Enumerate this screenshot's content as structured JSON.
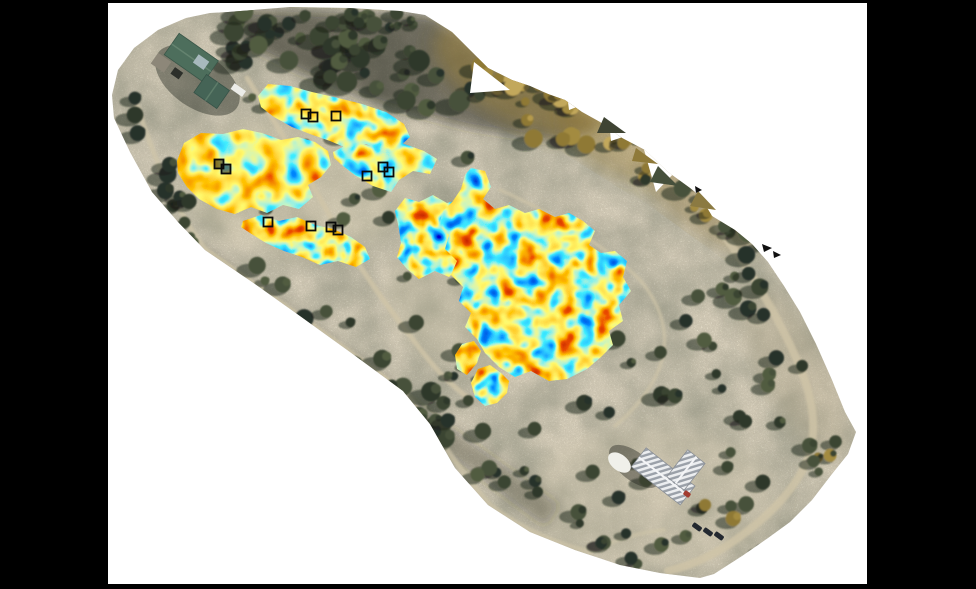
{
  "meta": {
    "description": "Aerial drone orthomosaic of a wooded survey site shown on a white figure canvas over a black background. Irregular geophysical (GPR) heatmap patches in a jet colormap are overlaid on mowed survey lanes; small black open squares mark excavation/test units. A green-roofed building complex sits at the upper left and a white metal-roofed building at the lower right, with dirt paths and scattered trees throughout.",
    "visible_text": []
  },
  "frame": {
    "background": "#000000",
    "canvas": {
      "fill": "#ffffff",
      "x": 108,
      "y": 3,
      "width": 759,
      "height": 581
    }
  },
  "palette": {
    "jet_stops": [
      "#000099",
      "#0033ff",
      "#00ccff",
      "#ffee33",
      "#ff9900",
      "#d91800",
      "#800000"
    ],
    "terrain_tan": "#a89a82",
    "road_tan": "#cfc4a8",
    "tree_dark": "#3a4431",
    "tree_gold": "#a8903f",
    "marker_black": "#0a0a0a",
    "roof_green": "#4d6e5c",
    "roof_white": "#eceef0"
  },
  "ortho": {
    "outline": "228,12 290,7 350,8 400,11 425,15 452,32 470,50 488,68 512,80 530,86 548,94 565,100 582,112 600,122 622,138 645,150 668,172 690,188 700,196 712,216 735,230 752,244 768,262 784,286 800,312 816,344 832,380 845,412 856,432 848,454 832,474 812,500 790,522 768,538 742,556 714,574 700,578 660,573 620,565 575,550 530,532 488,505 455,468 430,424 403,391 350,352 300,316 255,284 205,250 178,222 152,192 130,152 114,118 112,95 118,70 134,48 158,30 186,18 210,13",
    "terrain_noise": {
      "freq": 0.7,
      "octaves": 3,
      "seed": 9,
      "r_table": "0.50 0.72 0.58 0.80 0.64",
      "g_table": "0.46 0.66 0.53 0.74 0.59",
      "b_table": "0.36 0.52 0.42 0.60 0.47"
    }
  },
  "notches": [
    {
      "points": "474,62 510,90 470,93"
    },
    {
      "points": "643,146 696,150 656,192"
    },
    {
      "points": "566,86 592,101 569,110"
    },
    {
      "points": "609,121 629,135 611,141"
    }
  ],
  "teeth": [
    {
      "points": "604,117 626,133 597,133",
      "fill": "#3f4433"
    },
    {
      "points": "658,166 678,186 650,182",
      "fill": "#46503c"
    },
    {
      "points": "698,191 716,210 690,206",
      "fill": "#8b7a42"
    },
    {
      "points": "636,148 658,164 632,161",
      "fill": "#8f7a3a"
    }
  ],
  "tints": [
    {
      "shape": "polygon",
      "points": "232,10 430,16 600,124 560,142 470,128 380,104 300,72 240,42",
      "fill": "rgba(36,40,28,0.55)",
      "blur": "soft6"
    },
    {
      "shape": "ellipse",
      "cx": 520,
      "cy": 78,
      "rx": 95,
      "ry": 45,
      "rot": 28,
      "fill": "rgba(168,138,58,0.45)",
      "blur": "soft8"
    },
    {
      "shape": "ellipse",
      "cx": 615,
      "cy": 140,
      "rx": 62,
      "ry": 32,
      "rot": 32,
      "fill": "rgba(150,122,52,0.38)",
      "blur": "soft8"
    },
    {
      "shape": "ellipse",
      "cx": 698,
      "cy": 205,
      "rx": 70,
      "ry": 24,
      "rot": 36,
      "fill": "rgba(158,128,58,0.33)",
      "blur": "soft8"
    },
    {
      "shape": "ellipse",
      "cx": 300,
      "cy": 185,
      "rx": 115,
      "ry": 72,
      "rot": 0,
      "fill": "rgba(208,198,170,0.34)",
      "blur": "soft8"
    },
    {
      "shape": "ellipse",
      "cx": 498,
      "cy": 292,
      "rx": 112,
      "ry": 82,
      "rot": 0,
      "fill": "rgba(202,192,164,0.30)",
      "blur": "soft8"
    },
    {
      "shape": "ellipse",
      "cx": 652,
      "cy": 498,
      "rx": 125,
      "ry": 72,
      "rot": 0,
      "fill": "rgba(206,196,170,0.32)",
      "blur": "soft8"
    },
    {
      "shape": "polygon",
      "points": "205,250 560,505 545,527 193,263",
      "fill": "rgba(38,40,33,0.32)",
      "blur": "soft6"
    },
    {
      "shape": "ellipse",
      "cx": 795,
      "cy": 370,
      "rx": 95,
      "ry": 34,
      "rot": 62,
      "fill": "rgba(185,172,142,0.30)",
      "blur": "soft8"
    }
  ],
  "roads": {
    "color": "#cfc4a8",
    "items": [
      {
        "d": "M 136,102 C 152,152 172,206 206,250",
        "w": 5,
        "o": 0.75
      },
      {
        "d": "M 206,250 C 260,288 330,336 404,392 C 432,424 456,468 490,505 C 525,532 560,545 590,552",
        "w": 5.5,
        "o": 0.7
      },
      {
        "d": "M 247,78 C 280,130 310,180 335,225 C 360,270 393,314 424,354 C 438,372 456,390 472,400",
        "w": 5,
        "o": 0.8
      },
      {
        "d": "M 500,190 C 560,216 612,252 641,281 C 661,306 668,331 663,356 C 657,382 638,407 615,426",
        "w": 3.5,
        "o": 0.7
      },
      {
        "d": "M 718,228 C 746,263 776,312 798,362 C 812,396 818,426 809,456 C 796,490 768,517 734,541 C 712,556 690,566 668,571",
        "w": 8,
        "o": 0.8
      },
      {
        "d": "M 590,552 C 615,540 640,532 664,530",
        "w": 4,
        "o": 0.6
      },
      {
        "d": "M 452,205 L 492,287",
        "w": 4,
        "o": 0.7
      }
    ]
  },
  "trees": {
    "palettes": {
      "dark": [
        "#3a4431",
        "#2f3829",
        "#46513a",
        "#28302a",
        "#515c41"
      ],
      "gold": [
        "#a38b41",
        "#b59a4c",
        "#8f7936",
        "#c2a85c"
      ],
      "mixed": [
        "#3a4431",
        "#2f3829",
        "#a38b41",
        "#46513a",
        "#8f7936"
      ]
    },
    "shadow": "rgba(28,30,24,0.5)",
    "clusters": [
      {
        "type": "line",
        "x1": 238,
        "y1": 34,
        "x2": 470,
        "y2": 88,
        "spread": 26,
        "n": 44,
        "rmin": 5,
        "rmax": 11,
        "palette": "dark",
        "seed": 1
      },
      {
        "type": "line",
        "x1": 255,
        "y1": 16,
        "x2": 430,
        "y2": 20,
        "spread": 9,
        "n": 18,
        "rmin": 4,
        "rmax": 8,
        "palette": "dark",
        "seed": 2
      },
      {
        "type": "area",
        "x": 505,
        "y": 52,
        "w": 130,
        "h": 95,
        "n": 22,
        "rmin": 5,
        "rmax": 10,
        "palette": "gold",
        "seed": 3
      },
      {
        "type": "line",
        "x1": 455,
        "y1": 45,
        "x2": 560,
        "y2": 98,
        "spread": 18,
        "n": 12,
        "rmin": 4,
        "rmax": 9,
        "palette": "gold",
        "seed": 4
      },
      {
        "type": "line",
        "x1": 612,
        "y1": 132,
        "x2": 712,
        "y2": 208,
        "spread": 17,
        "n": 14,
        "rmin": 4,
        "rmax": 9,
        "palette": "mixed",
        "seed": 5
      },
      {
        "type": "line",
        "x1": 128,
        "y1": 102,
        "x2": 200,
        "y2": 246,
        "spread": 15,
        "n": 13,
        "rmin": 4,
        "rmax": 9,
        "palette": "dark",
        "seed": 6
      },
      {
        "type": "line",
        "x1": 210,
        "y1": 256,
        "x2": 556,
        "y2": 508,
        "spread": 20,
        "n": 40,
        "rmin": 4,
        "rmax": 10,
        "palette": "dark",
        "seed": 7
      },
      {
        "type": "area",
        "x": 545,
        "y": 215,
        "w": 270,
        "h": 215,
        "n": 42,
        "rmin": 4,
        "rmax": 9,
        "palette": "dark",
        "seed": 8
      },
      {
        "type": "area",
        "x": 565,
        "y": 430,
        "w": 200,
        "h": 135,
        "n": 18,
        "rmin": 4,
        "rmax": 8,
        "palette": "dark",
        "seed": 9
      },
      {
        "type": "area",
        "x": 338,
        "y": 122,
        "w": 130,
        "h": 215,
        "n": 15,
        "rmin": 4,
        "rmax": 8,
        "palette": "dark",
        "seed": 10
      },
      {
        "type": "area",
        "x": 232,
        "y": 92,
        "w": 105,
        "h": 175,
        "n": 9,
        "rmin": 3,
        "rmax": 6,
        "palette": "dark",
        "seed": 11
      },
      {
        "type": "area",
        "x": 430,
        "y": 345,
        "w": 125,
        "h": 105,
        "n": 11,
        "rmin": 4,
        "rmax": 8,
        "palette": "dark",
        "seed": 12
      },
      {
        "type": "area",
        "x": 700,
        "y": 425,
        "w": 140,
        "h": 100,
        "n": 10,
        "rmin": 4,
        "rmax": 8,
        "palette": "mixed",
        "seed": 13
      }
    ]
  },
  "heatmap": {
    "colormap": {
      "r_table": "0 0 0.05 1 1 0.85 0.5",
      "g_table": "0 0.25 0.85 0.95 0.55 0.08 0",
      "b_table": "0.62 1 1 0.15 0 0 0"
    },
    "filters": [
      {
        "id": "jet1",
        "seed": 11,
        "freq": 0.05,
        "slope": 2.0,
        "intercept": -0.5
      },
      {
        "id": "jet2",
        "seed": 29,
        "freq": 0.046,
        "slope": 1.65,
        "intercept": -0.3
      },
      {
        "id": "jet3",
        "seed": 5,
        "freq": 0.052,
        "slope": 2.2,
        "intercept": -0.6
      },
      {
        "id": "jet4",
        "seed": 17,
        "freq": 0.058,
        "slope": 2.0,
        "intercept": -0.5
      }
    ],
    "patches": [
      {
        "id": "patch-top-band",
        "filter": "jet1",
        "points": "258,96 268,84 290,86 312,92 338,98 362,104 386,112 404,124 410,137 399,147 382,151 366,144 349,149 330,141 310,134 292,127 274,117 261,107"
      },
      {
        "id": "patch-upper-right",
        "filter": "jet1",
        "points": "333,152 352,142 371,146 391,139 407,145 424,151 437,159 430,174 413,171 399,180 391,192 373,186 356,176 342,165 334,158"
      },
      {
        "id": "patch-big-left",
        "filter": "jet2",
        "points": "177,161 184,143 201,133 223,134 243,129 262,133 281,140 298,137 315,142 328,151 331,165 321,177 308,185 313,197 299,209 283,205 267,213 251,207 235,214 217,209 199,199 187,187 178,173"
      },
      {
        "id": "patch-left-lower-band",
        "filter": "jet4",
        "points": "243,221 261,215 279,221 297,217 315,225 333,229 351,237 365,247 370,259 356,267 338,261 320,265 302,257 284,251 266,243 250,233 241,227"
      },
      {
        "id": "patch-center-west-wing",
        "filter": "jet4",
        "points": "399,229 395,211 405,198 419,202 433,195 447,203 461,199 469,211 463,225 469,239 457,251 461,265 449,277 435,271 419,279 407,269 397,257 401,243"
      },
      {
        "id": "patch-center-main",
        "filter": "jet3",
        "points": "471,168 485,171 491,187 483,199 495,209 509,205 525,213 539,209 555,217 569,213 583,221 595,231 589,245 601,253 615,251 627,261 623,277 631,291 619,305 623,321 609,331 613,345 601,357 587,369 567,379 549,381 531,371 515,377 499,367 485,353 477,339 465,327 471,313 459,301 463,287 451,275 457,261 445,249 449,235 439,225 443,211 453,201 461,189 465,175"
      },
      {
        "id": "patch-small-south-1",
        "filter": "jet3",
        "points": "462,344 474,341 481,351 477,363 467,375 457,369 455,355"
      },
      {
        "id": "patch-small-south-2",
        "filter": "jet4",
        "points": "478,369 490,365 501,373 509,381 507,393 497,403 485,406 475,397 471,383"
      }
    ]
  },
  "markers": {
    "size": 9,
    "stroke": "#0a0a0a",
    "stroke_width": 1.8,
    "items": [
      {
        "x": 306,
        "y": 114,
        "style": "open"
      },
      {
        "x": 313,
        "y": 117,
        "style": "open"
      },
      {
        "x": 336,
        "y": 116,
        "style": "open"
      },
      {
        "x": 219,
        "y": 164,
        "style": "dark"
      },
      {
        "x": 226,
        "y": 169,
        "style": "dark"
      },
      {
        "x": 367,
        "y": 176,
        "style": "open"
      },
      {
        "x": 383,
        "y": 167,
        "style": "open"
      },
      {
        "x": 389,
        "y": 172,
        "style": "open"
      },
      {
        "x": 268,
        "y": 222,
        "style": "open"
      },
      {
        "x": 311,
        "y": 226,
        "style": "open"
      },
      {
        "x": 331,
        "y": 227,
        "style": "open"
      },
      {
        "x": 338,
        "y": 230,
        "style": "open"
      }
    ]
  },
  "buildings": {
    "green_complex": {
      "tx": 196,
      "ty": 72,
      "rot": 35,
      "parts": [
        {
          "type": "ellipse",
          "cx": 6,
          "cy": 6,
          "rx": 48,
          "ry": 27,
          "fill": "rgba(45,48,40,0.45)"
        },
        {
          "type": "rect",
          "x": -36,
          "y": -22,
          "w": 48,
          "h": 26,
          "fill": "#4d6e5c",
          "stroke": "#3a5648"
        },
        {
          "type": "line",
          "x1": -36,
          "y1": -9,
          "x2": 12,
          "y2": -9,
          "stroke": "#64836f",
          "w": 1.5
        },
        {
          "type": "rect",
          "x": 10,
          "y": -4,
          "w": 28,
          "h": 22,
          "fill": "#456456",
          "stroke": "#365247"
        },
        {
          "type": "line",
          "x1": 24,
          "y1": -4,
          "x2": 24,
          "y2": 18,
          "stroke": "#5d7c69",
          "w": 1.5
        },
        {
          "type": "rect",
          "x": -8,
          "y": -16,
          "w": 13,
          "h": 10,
          "fill": "#a7b9bd"
        },
        {
          "type": "rect",
          "x": -42,
          "y": 6,
          "w": 16,
          "h": 13,
          "fill": "#8d8779"
        },
        {
          "type": "rect",
          "x": 38,
          "y": -13,
          "w": 14,
          "h": 7,
          "fill": "#ecece8"
        },
        {
          "type": "rect",
          "x": -20,
          "y": 8,
          "w": 10,
          "h": 8,
          "fill": "#2c2f2a"
        }
      ]
    },
    "white_church": {
      "tx": 664,
      "ty": 477,
      "rot": 38,
      "parts": [
        {
          "type": "ellipse",
          "cx": -30,
          "cy": 10,
          "rx": 30,
          "ry": 14,
          "fill": "rgba(28,30,26,0.40)"
        },
        {
          "type": "rect",
          "x": -32,
          "y": -12,
          "w": 62,
          "h": 24,
          "fill": "stripe",
          "stroke": "#8a8f96"
        },
        {
          "type": "rect",
          "x": 2,
          "y": -36,
          "w": 22,
          "h": 34,
          "fill": "stripe",
          "stroke": "#8a8f96"
        },
        {
          "type": "line",
          "x1": -32,
          "y1": 0,
          "x2": 30,
          "y2": 0,
          "stroke": "#f4f5f7",
          "w": 2
        },
        {
          "type": "line",
          "x1": 13,
          "y1": -36,
          "x2": 13,
          "y2": -2,
          "stroke": "#f4f5f7",
          "w": 2
        },
        {
          "type": "ellipse",
          "cx": -44,
          "cy": 16,
          "rx": 13,
          "ry": 8,
          "fill": "#f0f0ea"
        }
      ]
    }
  },
  "vehicles": {
    "fill": "#232830",
    "w": 10,
    "h": 5,
    "rot": 36,
    "items": [
      {
        "x": 697,
        "y": 527
      },
      {
        "x": 708,
        "y": 532
      },
      {
        "x": 719,
        "y": 536
      }
    ],
    "red_item": {
      "x": 687,
      "y": 494,
      "fill": "#a23c30",
      "w": 7,
      "h": 5
    }
  },
  "specks": [
    {
      "points": "762,244 772,248 764,252"
    },
    {
      "points": "773,251 781,255 774,258"
    },
    {
      "points": "695,186 702,190 696,193"
    }
  ]
}
